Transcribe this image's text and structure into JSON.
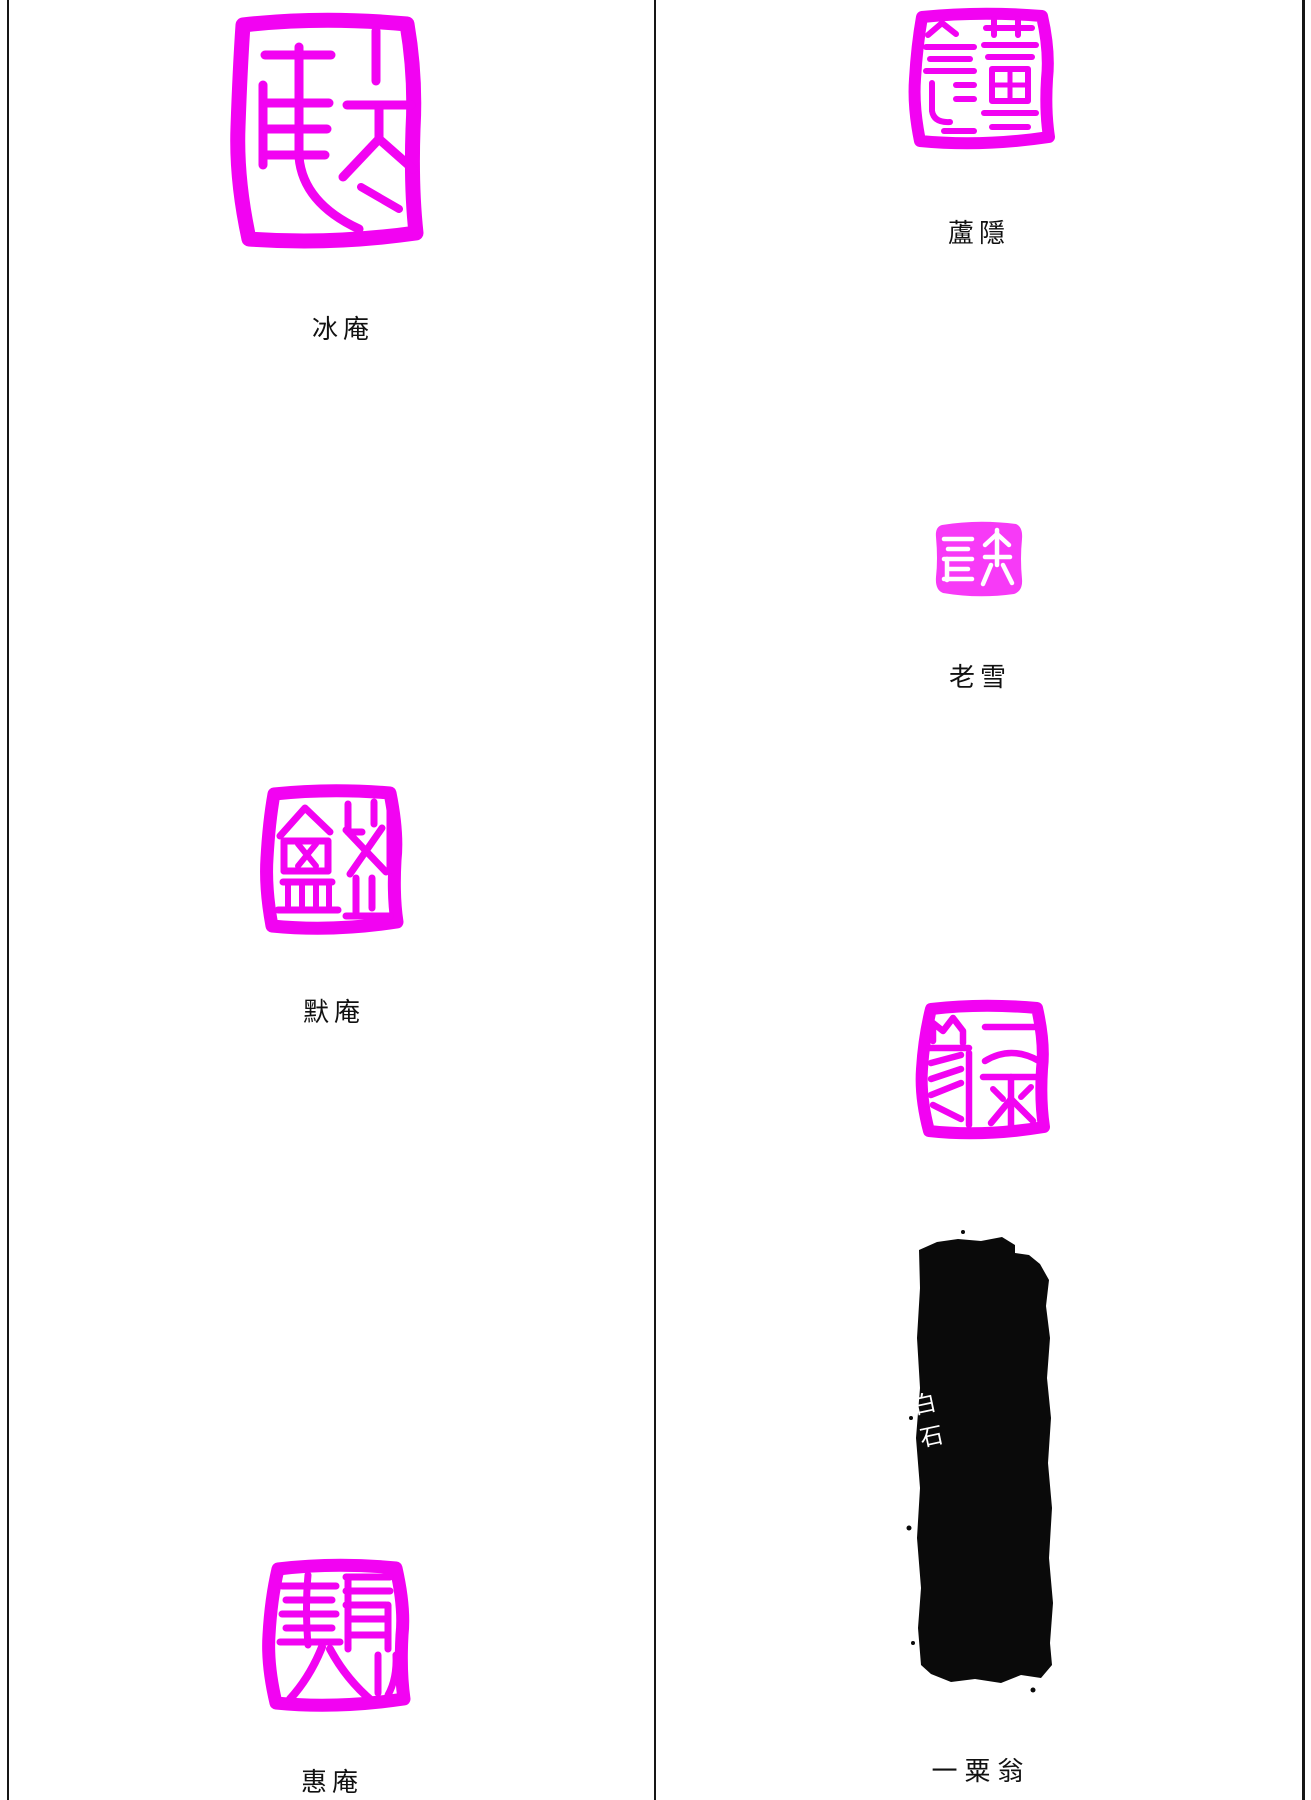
{
  "page": {
    "background": "#ffffff",
    "seal_color": "#f203f2",
    "seal_color_light": "#f73af7",
    "ink_color": "#0a0a0a",
    "caption_color": "#111111",
    "rule_color": "#161616"
  },
  "left_column": {
    "seals": [
      {
        "id": "bing-an",
        "caption": "冰庵",
        "style": "relief-outline"
      },
      {
        "id": "mo-an",
        "caption": "默庵",
        "style": "relief-outline"
      },
      {
        "id": "hui-an",
        "caption": "惠庵",
        "style": "relief-outline"
      }
    ]
  },
  "right_column": {
    "seals": [
      {
        "id": "lu-yin",
        "caption": "蘆隱",
        "style": "relief-outline"
      },
      {
        "id": "lao-xue",
        "caption": "老雪",
        "style": "intaglio-solid"
      },
      {
        "id": "yi-su-weng",
        "caption": "一粟翁",
        "style": "relief-outline"
      }
    ],
    "side_inscription_text": "白石"
  }
}
